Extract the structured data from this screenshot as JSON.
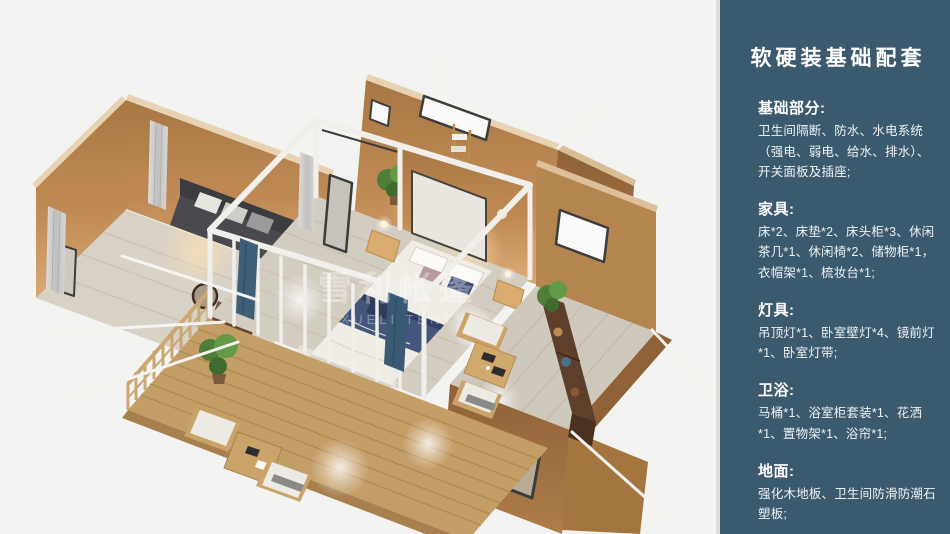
{
  "panel": {
    "title": "软硬装基础配套",
    "sections": [
      {
        "header": "基础部分:",
        "body": "卫生间隔断、防水、水电系统（强电、弱电、给水、排水）、开关面板及插座;"
      },
      {
        "header": "家具:",
        "body": "床*2、床垫*2、床头柜*3、休闲茶几*1、休闲椅*2、储物柜*1，衣帽架*1、梳妆台*1;"
      },
      {
        "header": "灯具:",
        "body": "吊顶灯*1、卧室壁灯*4、镜前灯*1、卧室灯带;"
      },
      {
        "header": "卫浴:",
        "body": "马桶*1、浴室柜套装*1、花洒*1、置物架*1、浴帘*1;"
      },
      {
        "header": "地面:",
        "body": "强化木地板、卫生间防滑防潮石塑板;"
      }
    ]
  },
  "render": {
    "watermark_line1": "雪利帐篷",
    "watermark_line2": "XUELI TENT"
  },
  "colors": {
    "panel_background": "#3c5a6d",
    "divider": "#dcdcda",
    "page_background": "#f3f3f1",
    "wall_tan": "#c08a55",
    "wall_tan_dark": "#a1713f",
    "deck_wood": "#c49e67",
    "floor_gray": "#d3ccc1",
    "bed_navy": "#44567c",
    "frame_white": "#f0efeb",
    "plant_green": "#4e7e38",
    "teal_curtain": "#3e5f78"
  }
}
